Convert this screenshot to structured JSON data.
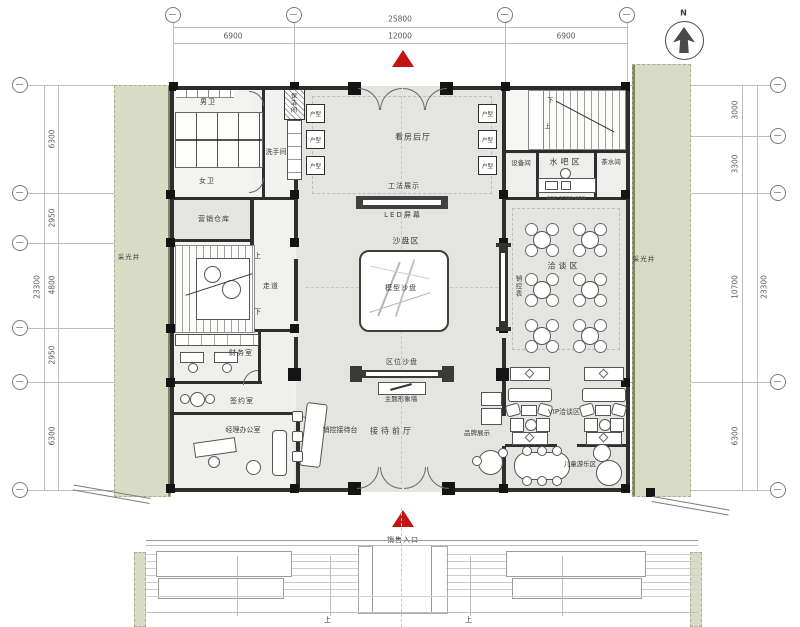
{
  "north": {
    "label": "N"
  },
  "dims": {
    "top_total": "25800",
    "top_segments": [
      "6900",
      "12000",
      "6900"
    ],
    "left_total": "23300",
    "left_segments": [
      "6300",
      "2950",
      "4800",
      "2950",
      "6300"
    ],
    "right_total": "23300",
    "right_segments": [
      "3000",
      "3300",
      "10700",
      "6300"
    ],
    "bar_segments": "600 2700 600"
  },
  "labels": {
    "men_wc": "男卫",
    "women_wc": "女卫",
    "washroom": "洗手间",
    "cleaning_room": "保洁间",
    "viewing_hall": "看房后厅",
    "unit_display": "户型",
    "construction_display": "工法展示",
    "led_screen": "LED屏幕",
    "sand_table_area": "沙盘区",
    "model_sand_table": "模型沙盘",
    "equipment_room": "设备间",
    "water_bar": "水吧区",
    "tea_room": "茶水间",
    "negotiation_area": "洽谈区",
    "sales_control_board": "销控表",
    "light_well": "采光井",
    "marketing_warehouse": "营销仓库",
    "corridor": "走道",
    "stair_up": "上",
    "stair_down": "下",
    "finance_room": "财务室",
    "signing_room": "签约室",
    "manager_office": "经理办公室",
    "reception_desk": "销控接待台",
    "reception_hall": "接待前厅",
    "brand_display": "品牌展示",
    "location_sand_table": "区位沙盘",
    "theme_wall": "主题形象墙",
    "vip_area": "VIP洽谈区",
    "kids_area": "儿童游乐区",
    "sales_entrance": "销售入口"
  },
  "colors": {
    "floor": "#e4e4e1",
    "wall": "#2e2e2e",
    "green_strip": "#d8dcc5",
    "entrance_red": "#c31414",
    "dim_text": "#5a5a5a"
  }
}
